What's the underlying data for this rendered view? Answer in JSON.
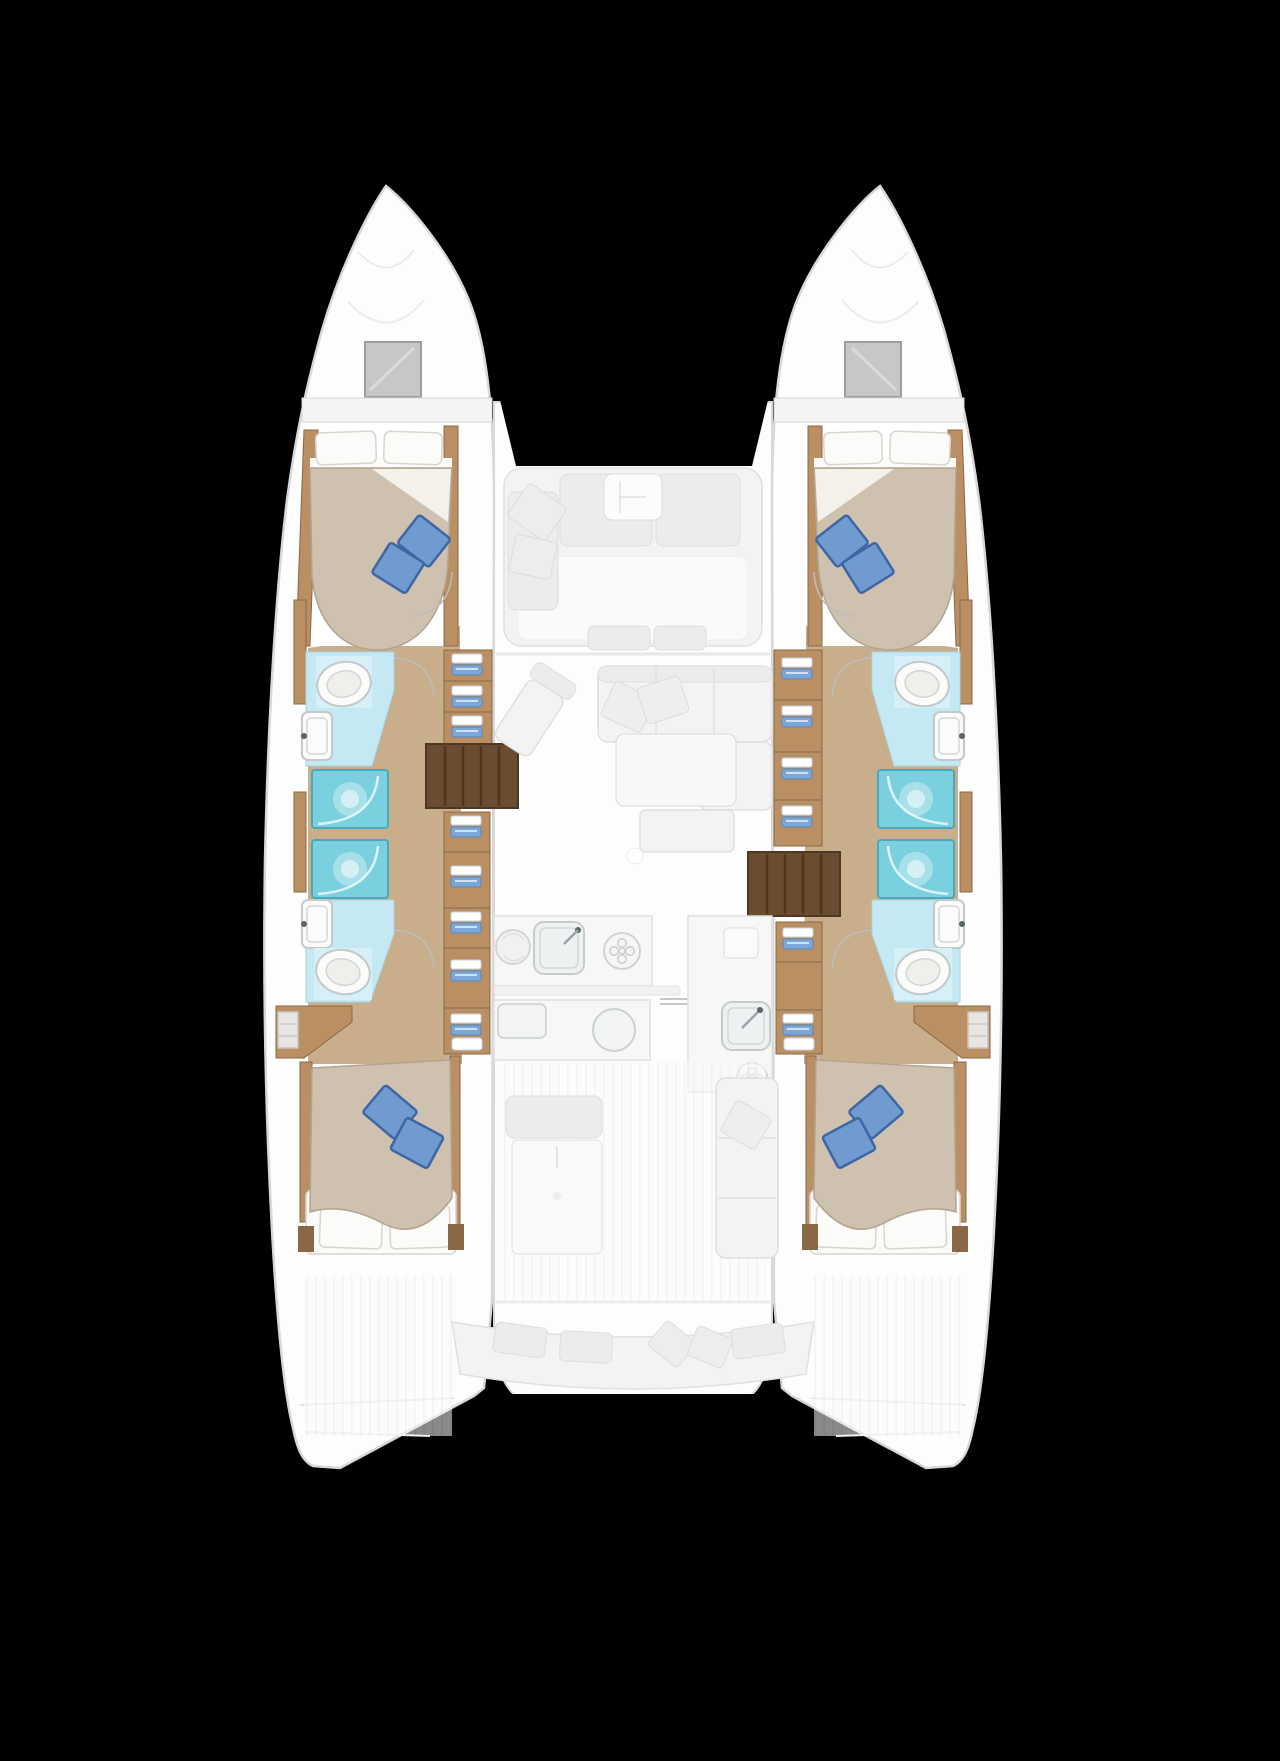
{
  "image": {
    "width": 1280,
    "height": 1761,
    "kind": "catamaran-deck-plan-top-view"
  },
  "colors": {
    "background": "#000000",
    "hull_white": "#fdfdfd",
    "hull_outline": "#d8d8d8",
    "hatch_gray": "#c7c7c7",
    "hatch_border": "#9e9e9e",
    "wood_floor": "#c9ae8c",
    "wood_mid": "#b98f63",
    "wood_dark": "#8a6845",
    "stairs_dark": "#6b4c31",
    "stairs_line": "#4e3723",
    "bathroom_floor": "#c5e9f2",
    "shower_teal": "#7ad0de",
    "shower_edge": "#4aa8bb",
    "bed_duvet": "#cec1af",
    "bed_edge": "#b3a48f",
    "linen_white": "#fbfbf9",
    "linen_outline": "#d8d5cf",
    "pillow_blue": "#6f9bd0",
    "pillow_blue_dark": "#3f66a4",
    "clothes_blue": "#7ba7d9",
    "ghost_fill": "#f3f3f3",
    "ghost_line": "#e0e0e0",
    "fixture_line": "#c2c9cb",
    "door_arc": "#bdbdbd"
  },
  "vessel": {
    "view": "top-down floor plan, bows up",
    "hulls": [
      "port",
      "starboard"
    ],
    "per_hull_rooms": [
      "bow-locker",
      "deck-hatch",
      "forward-cabin",
      "forward-head",
      "shower-forward",
      "shower-aft",
      "aft-head",
      "aft-cabin"
    ],
    "center_areas": [
      "foredeck-gap",
      "forward-cockpit",
      "salon",
      "galley",
      "walkway",
      "aft-cockpit",
      "transom-gap"
    ],
    "cabin_count": 4,
    "head_count": 4,
    "shower_count": 4,
    "double_berth_count": 4,
    "blue_accent_pillows_per_berth": 2
  },
  "icons": {
    "toilet": "toilet-icon",
    "sink": "sink-icon",
    "stove_burner": "burner-icon",
    "galley_sink": "galley-sink-icon",
    "companionway_stairs": "stairs-icon",
    "wardrobe_clothes": "folded-clothes-icon",
    "deck_hatch": "hatch-icon",
    "door_swing": "door-arc-icon"
  }
}
